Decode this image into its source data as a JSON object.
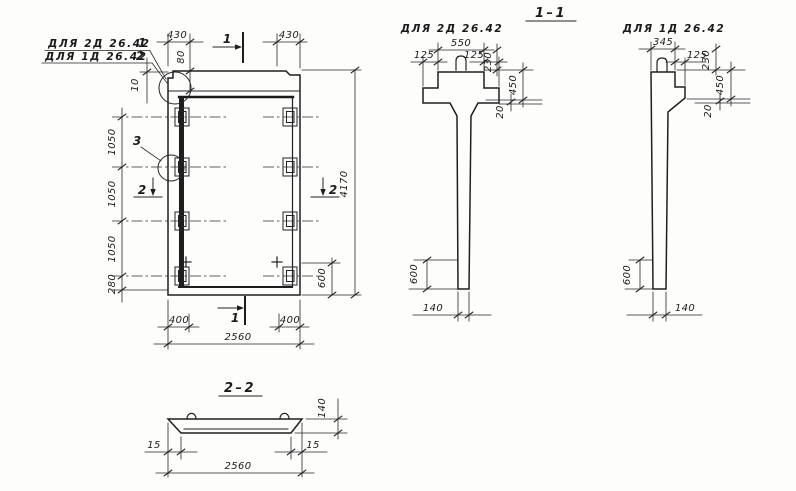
{
  "canvas": {
    "paper": "#fdfdfc",
    "ink": "#1f1f1f"
  },
  "notes": {
    "line1_text": "ДЛЯ 2Д 26.42",
    "line1_pos": "1",
    "line2_text": "ДЛЯ 1Д 26.42",
    "line2_pos": "2"
  },
  "front_view": {
    "dim_430_left": "430",
    "dim_430_right": "430",
    "dim_80": "80",
    "dim_10": "10",
    "dim_1050_a": "1050",
    "dim_1050_b": "1050",
    "dim_1050_c": "1050",
    "dim_280": "280",
    "dim_4170": "4170",
    "dim_600": "600",
    "dim_400_left": "400",
    "dim_400_right": "400",
    "dim_2560": "2560",
    "mark_cut1_top": "1",
    "mark_cut1_bottom": "1",
    "mark_cut2_left": "2",
    "mark_cut2_right": "2",
    "mark_detail": "3"
  },
  "section_1_1": {
    "title": "1–1",
    "variant": "ДЛЯ 2Д 26.42",
    "dim_550": "550",
    "dim_125_left": "125",
    "dim_125_right": "125",
    "dim_230": "230",
    "dim_450": "450",
    "dim_20": "20",
    "dim_600": "600",
    "dim_140": "140"
  },
  "section_1_1_alt": {
    "variant": "ДЛЯ 1Д 26.42",
    "dim_345": "345",
    "dim_125": "125",
    "dim_230": "230",
    "dim_450": "450",
    "dim_20": "20",
    "dim_600": "600",
    "dim_140": "140"
  },
  "section_2_2": {
    "title": "2–2",
    "dim_140": "140",
    "dim_15_left": "15",
    "dim_15_right": "15",
    "dim_2560": "2560"
  }
}
